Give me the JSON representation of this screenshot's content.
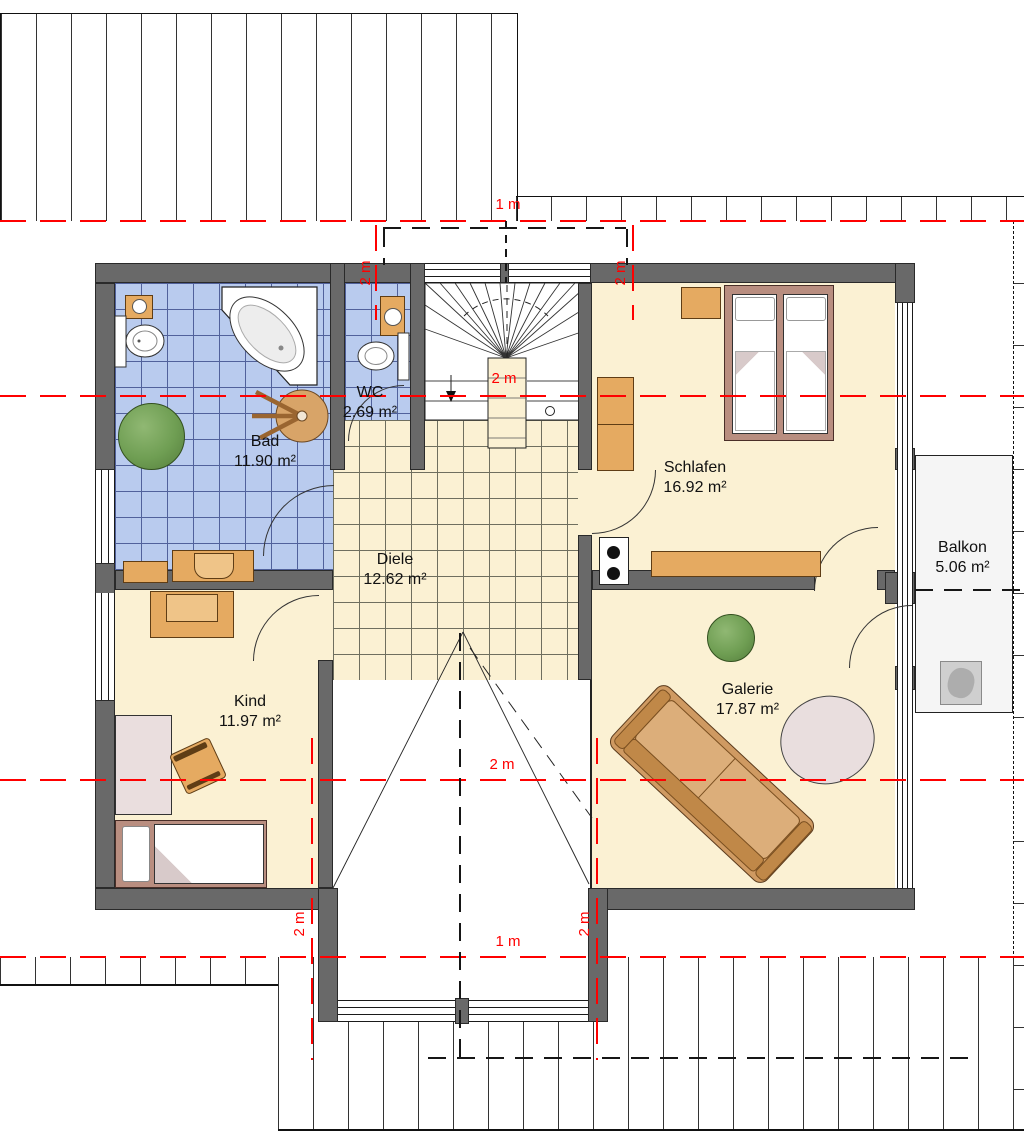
{
  "plan": {
    "rooms": {
      "bad": {
        "name": "Bad",
        "area": "11.90 m²"
      },
      "wc": {
        "name": "WC",
        "area": "2.69 m²"
      },
      "schlafen": {
        "name": "Schlafen",
        "area": "16.92 m²"
      },
      "diele": {
        "name": "Diele",
        "area": "12.62 m²"
      },
      "kind": {
        "name": "Kind",
        "area": "11.97 m²"
      },
      "galerie": {
        "name": "Galerie",
        "area": "17.87 m²"
      },
      "balkon": {
        "name": "Balkon",
        "area": "5.06 m²"
      }
    },
    "dimension_labels": {
      "roof_top": "1 m",
      "dormer_top_left": "2 m",
      "dormer_top_right": "2 m",
      "stairwell": "2 m",
      "void": "2 m",
      "roof_bottom": "1 m",
      "dormer_bottom_left": "2 m",
      "dormer_bottom_right": "2 m"
    },
    "colors": {
      "wall_gray": "#696969",
      "bath_tile_blue": "#b9cbee",
      "tile_grid_blue": "#51619b",
      "floor_cream": "#fbf1d3",
      "annotation_red": "#ff0000",
      "furniture_wood": "#e5aa61",
      "bed_frame_mauve": "#b98e80",
      "plant_green": "#6f9e53",
      "sofa_tan": "#cf9a62",
      "balcony_gray": "#f5f5f5"
    }
  }
}
